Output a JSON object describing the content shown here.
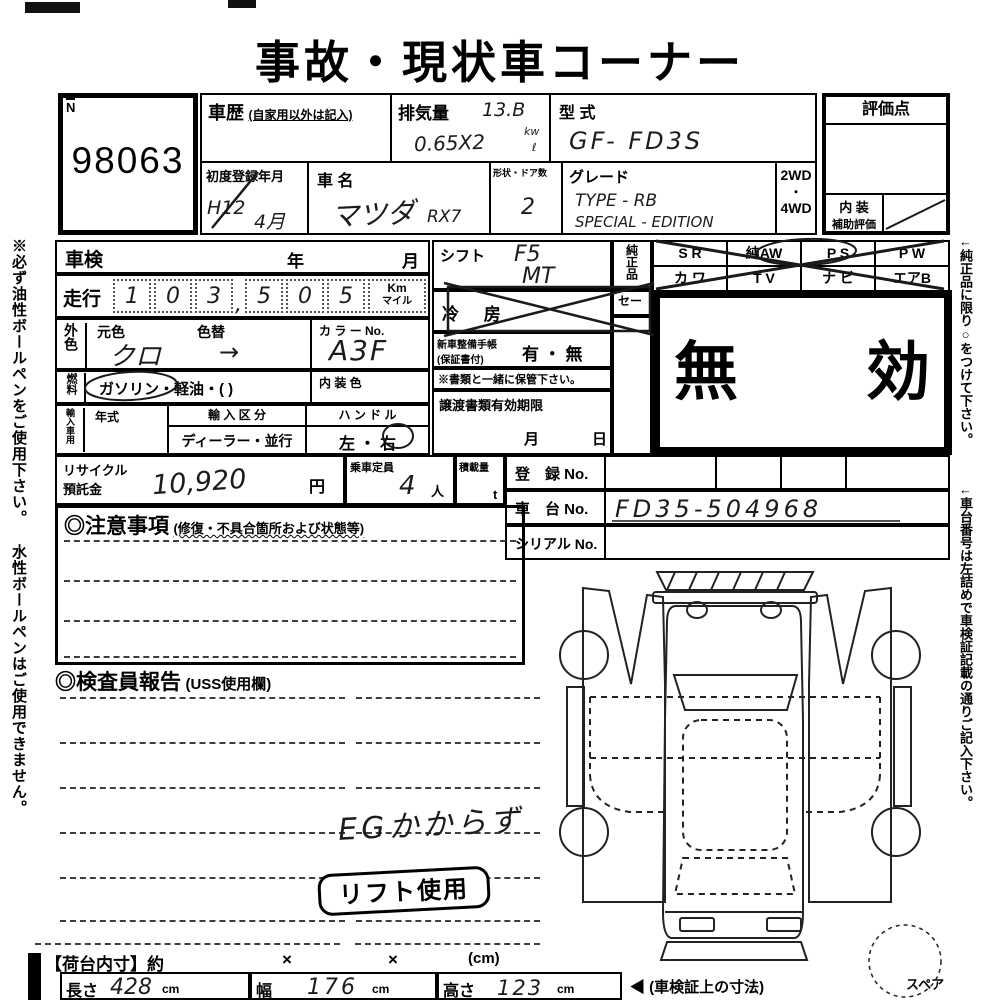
{
  "colors": {
    "ink": "#000000",
    "paper": "#ffffff",
    "pencil": "#1a1a1a"
  },
  "title": "事故・現状車コーナー",
  "side_notes": {
    "left": "※必ず油性ボールペンをご使用下さい。 水性ボールペンはご使用できません。",
    "right_top": "←純正品に限り○をつけて下さい。",
    "right_bottom": "←車台番号は左詰めで車検証記載の通りご記入下さい。",
    "spare": "スペア"
  },
  "auction_no": {
    "label": "N",
    "value": "98063"
  },
  "header": {
    "history_label": "車歴",
    "history_note": "(自家用以外は記入)",
    "displacement_label": "排気量",
    "displacement_line1": "13.B",
    "displacement_line2": "0.65X2",
    "displacement_unit1": "kw",
    "displacement_unit2": "ℓ",
    "model_code_label": "型 式",
    "model_code_value": "GF- FD3S",
    "first_reg_label": "初度登録年月",
    "first_reg_era": "H12",
    "first_reg_month": "4月",
    "car_name_label": "車 名",
    "car_name_value": "マツダ",
    "car_name_value2": "RX7",
    "body_doors_label": "形状・ドア数",
    "body_doors_value": "2",
    "grade_label": "グレード",
    "grade_line1": "TYPE - RB",
    "grade_line2": "SPECIAL - EDITION",
    "wd2": "2WD",
    "wd_dot": "・",
    "wd4": "4WD"
  },
  "score_box": {
    "title": "評価点",
    "interior_label1": "内 装",
    "interior_label2": "補助評価"
  },
  "left_table": {
    "shaken_label": "車検",
    "year": "年",
    "month": "月",
    "mileage_label": "走行",
    "digits": [
      "1",
      "0",
      "3",
      "5",
      "0",
      "5"
    ],
    "comma": ",",
    "unit_km": "Km",
    "unit_mile": "マイル",
    "ext_color_label": "外色",
    "base_color_label": "元色",
    "base_color_value": "クロ",
    "color_change_label": "色替",
    "color_change_value": "→",
    "color_no_label": "カ ラ ー No.",
    "color_no_value": "A3F",
    "fuel_label": "燃料",
    "fuel_gasoline": "ガソリン",
    "fuel_rest": "・軽油・(            )",
    "interior_color_label": "内 装 色",
    "import_label": "輸入車用",
    "year_model_label": "年式",
    "import_class_label": "輸 入 区 分",
    "import_class_value": "ディーラー・並行",
    "handle_label": "ハ ン ド ル",
    "handle_value_left": "左",
    "handle_dot": "・",
    "handle_value_right": "右"
  },
  "middle_table": {
    "shift_label": "シフト",
    "shift_value": "F5",
    "shift_value2": "MT",
    "ac_label": "冷 房",
    "booklet_label1": "新車整備手帳",
    "booklet_label2": "(保証書付)",
    "booklet_value": "有 ・ 無",
    "booklet_note": "※書類と一緒に保管下さい。",
    "transfer_label": "譲渡書類有効期限",
    "transfer_month": "月",
    "transfer_day": "日",
    "genuine_label": "純正品",
    "se_label": "セー"
  },
  "options": {
    "r1c1": "S R",
    "r1c2": "純AW",
    "r1c3": "P S",
    "r1c4": "P W",
    "r2c1": "カ ワ",
    "r2c2": "T V",
    "r2c3": "ナ ビ",
    "r2c4": "エアB"
  },
  "stamp": {
    "invalid": "無　　効"
  },
  "recycle": {
    "label1": "リサイクル",
    "label2": "預託金",
    "value": "10,920",
    "unit": "円",
    "capacity_label": "乗車定員",
    "capacity_value": "4",
    "capacity_unit": "人",
    "load_label": "積載量",
    "load_unit": "t"
  },
  "registration": {
    "reg_label": "登　録 No.",
    "chassis_label": "車　台 No.",
    "chassis_value": "FD35-504968",
    "serial_label": "シリアル No."
  },
  "notes_section": {
    "title": "◎注意事項",
    "subtitle": "(修復・不具合箇所および状態等)"
  },
  "inspector_section": {
    "title": "◎検査員報告",
    "subtitle": "(USS使用欄)",
    "handwritten_note": "EGかからず",
    "lift_stamp": "リフト使用"
  },
  "dimensions": {
    "title": "【荷台内寸】約",
    "times1": "×",
    "times2": "×",
    "unit": "(cm)",
    "length_label": "長さ",
    "length_value": "428",
    "width_label": "幅",
    "width_value": "176",
    "height_label": "高さ",
    "height_value": "123",
    "cm1": "cm",
    "cm2": "cm",
    "cm3": "cm",
    "arrow_note": "◀ (車検証上の寸法)"
  }
}
